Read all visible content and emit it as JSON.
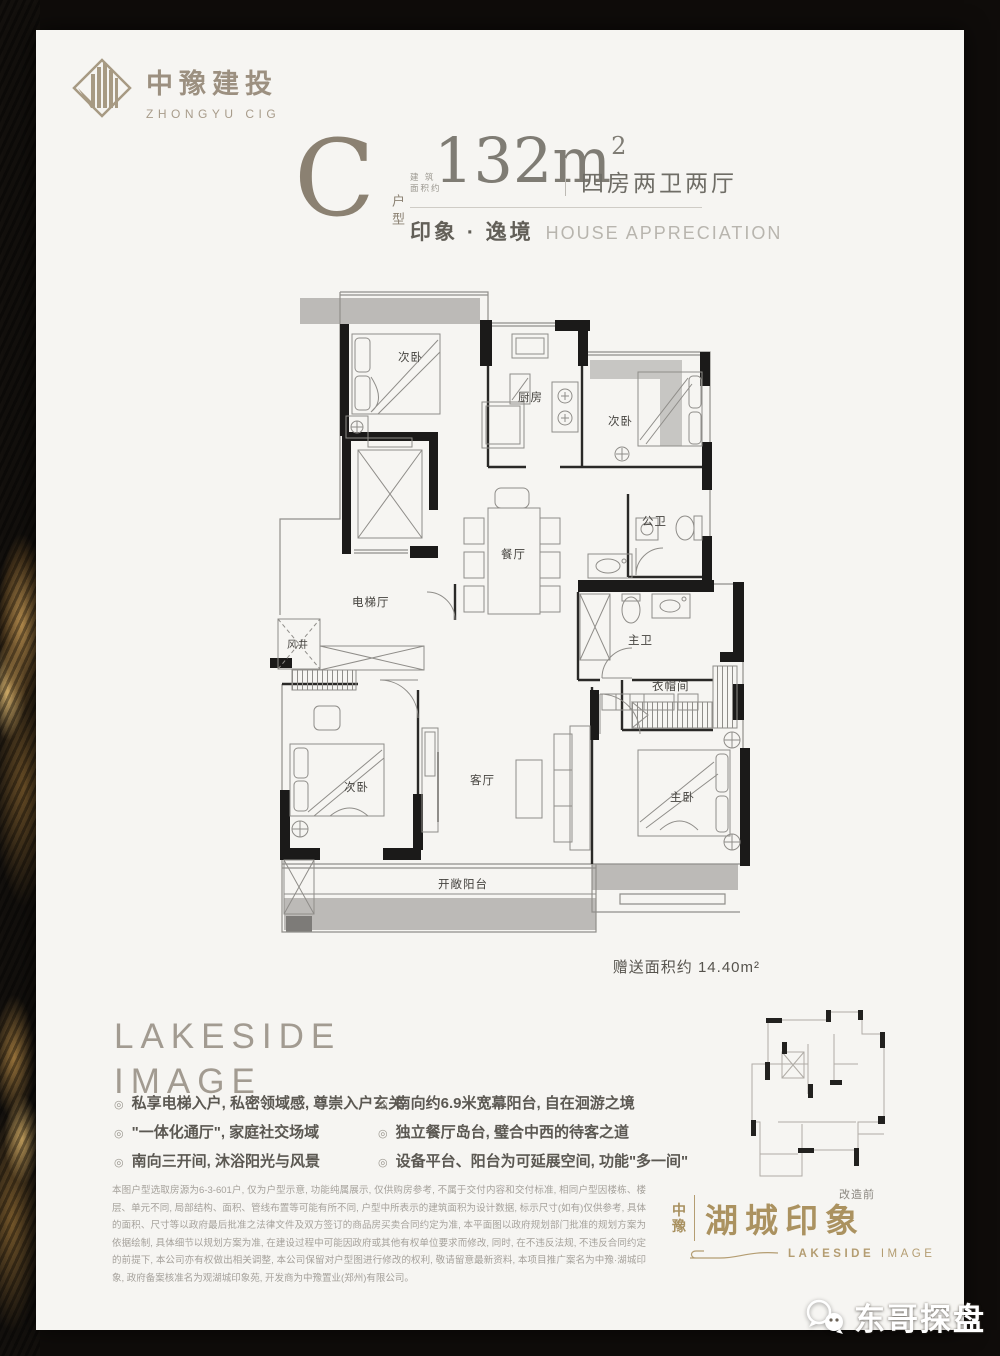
{
  "logo": {
    "name_cn": "中豫建投",
    "name_en": "ZHONGYU CIG"
  },
  "header": {
    "type_letter": "C",
    "type_label_vertical": "户型",
    "area_prefix_top": "建 筑",
    "area_prefix_bottom": "面积约",
    "area_value": "132m",
    "area_exp": "2",
    "rooms_summary": "四房两卫两厅",
    "tagline_cn": "印象 · 逸境",
    "tagline_en": "HOUSE APPRECIATION"
  },
  "floor_plan": {
    "labels": {
      "bedroom_top_left": "次卧",
      "kitchen": "厨房",
      "bedroom_top_right": "次卧",
      "public_bath": "公卫",
      "dining": "餐厅",
      "elevator_hall": "电梯厅",
      "air_shaft": "风井",
      "master_bath": "主卫",
      "cloakroom": "衣帽间",
      "bedroom_bottom": "次卧",
      "living": "客厅",
      "master_bedroom": "主卧",
      "balcony": "开敞阳台"
    },
    "bonus_note": "赠送面积约 14.40m²"
  },
  "features": {
    "title_line1": "LAKESIDE",
    "title_line2": "IMAGE",
    "marker": "◎",
    "left": [
      "私享电梯入户, 私密领域感, 尊崇入户玄关",
      "\"一体化通厅\", 家庭社交场域",
      "南向三开间, 沐浴阳光与风景"
    ],
    "right": [
      "南向约6.9米宽幕阳台, 自在洄游之境",
      "独立餐厅岛台, 璧合中西的待客之道",
      "设备平台、阳台为可延展空间, 功能\"多一间\""
    ]
  },
  "disclaimer": "本图户型选取房源为6-3-601户, 仅为户型示意, 功能纯属展示, 仅供购房参考, 不属于交付内容和交付标准, 相同户型因楼栋、楼层、单元不同, 局部结构、面积、管线布置等可能有所不同, 户型中所表示的建筑面积为设计数据, 标示尺寸(如有)仅供参考, 具体的面积、尺寸等以政府最后批准之法律文件及双方签订的商品房买卖合同约定为准, 本平面图以政府规划部门批准的规划方案为依据绘制, 具体细节以规划方案为准, 在建设过程中可能因政府或其他有权单位要求而修改, 同时, 在不违反法规, 不违反合同约定的前提下, 本公司亦有权做出相关调整, 本公司保留对户型图进行修改的权利, 敬请留意最新资料, 本项目推广案名为中豫·湖城印象, 政府备案核准名为观湖城印象苑, 开发商为中豫置业(郑州)有限公司。",
  "brand": {
    "prefix_char1": "中",
    "prefix_char2": "豫",
    "name": "湖城印象",
    "name_en_bold": "LAKESIDE",
    "name_en_light": "IMAGE"
  },
  "thumbnail": {
    "caption": "改造前"
  },
  "watermark": {
    "text": "东哥探盘"
  }
}
